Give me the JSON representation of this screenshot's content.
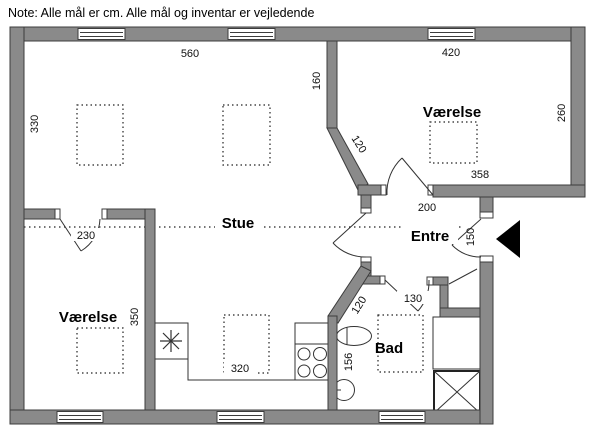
{
  "note": "Note: Alle mål er cm. Alle mål og inventar er vejledende",
  "rooms": {
    "living": "Stue",
    "entry": "Entre",
    "bath": "Bad",
    "bedroom_ne": "Værelse",
    "bedroom_sw": "Værelse"
  },
  "dimensions": {
    "stue_width": "560",
    "bedroom_ne_width_top": "420",
    "stue_height": "330",
    "hall_wall_upper": "160",
    "diag_upper": "120",
    "bedroom_ne_height": "260",
    "bedroom_ne_width_bottom": "358",
    "entry_width": "200",
    "entry_door": "150",
    "bedroom_sw_door": "230",
    "bedroom_sw_height": "350",
    "kitchen_width": "320",
    "bath_door": "130",
    "diag_lower": "120",
    "bath_width": "156"
  },
  "colors": {
    "wall_fill": "#8a8a8a",
    "wall_stroke": "#3c3c3c",
    "line": "#333333",
    "background": "#ffffff",
    "entrance_marker": "#000000"
  }
}
